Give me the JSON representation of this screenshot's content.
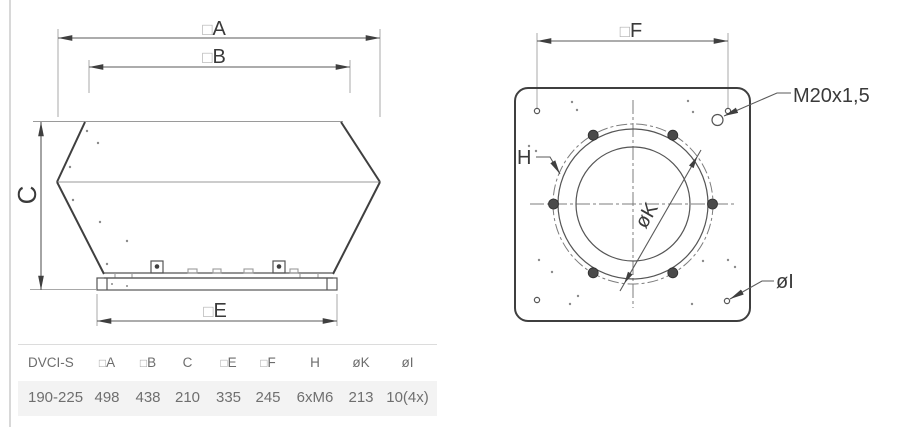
{
  "drawing": {
    "side_view": {
      "dim_a": {
        "pre": "□",
        "letter": "A"
      },
      "dim_b": {
        "pre": "□",
        "letter": "B"
      },
      "dim_c": {
        "letter": "C"
      },
      "dim_e": {
        "pre": "□",
        "letter": "E"
      }
    },
    "bottom_view": {
      "dim_f": {
        "pre": "□",
        "letter": "F"
      },
      "thread_label": "M20x1,5",
      "dim_h": "H",
      "dim_k": {
        "pre": "ø",
        "letter": "K"
      },
      "dim_i": {
        "pre": "ø",
        "letter": "I"
      }
    }
  },
  "table": {
    "columns": [
      {
        "pre": "",
        "label": "DVCI-S"
      },
      {
        "pre": "□",
        "label": "A"
      },
      {
        "pre": "□",
        "label": "B"
      },
      {
        "pre": "",
        "label": "C"
      },
      {
        "pre": "□",
        "label": "E"
      },
      {
        "pre": "□",
        "label": "F"
      },
      {
        "pre": "",
        "label": "H"
      },
      {
        "pre": "",
        "label": "øK"
      },
      {
        "pre": "",
        "label": "øI"
      }
    ],
    "rows": [
      [
        "190-225",
        "498",
        "438",
        "210",
        "335",
        "245",
        "6xM6",
        "213",
        "10(4x)"
      ]
    ]
  },
  "colors": {
    "outline_dark": "#3f3f3f",
    "dimension_line": "#5a5a5a",
    "extension_line": "#a8a8a8",
    "row_background": "#f3f3f3",
    "table_text": "#6d6d6d"
  }
}
